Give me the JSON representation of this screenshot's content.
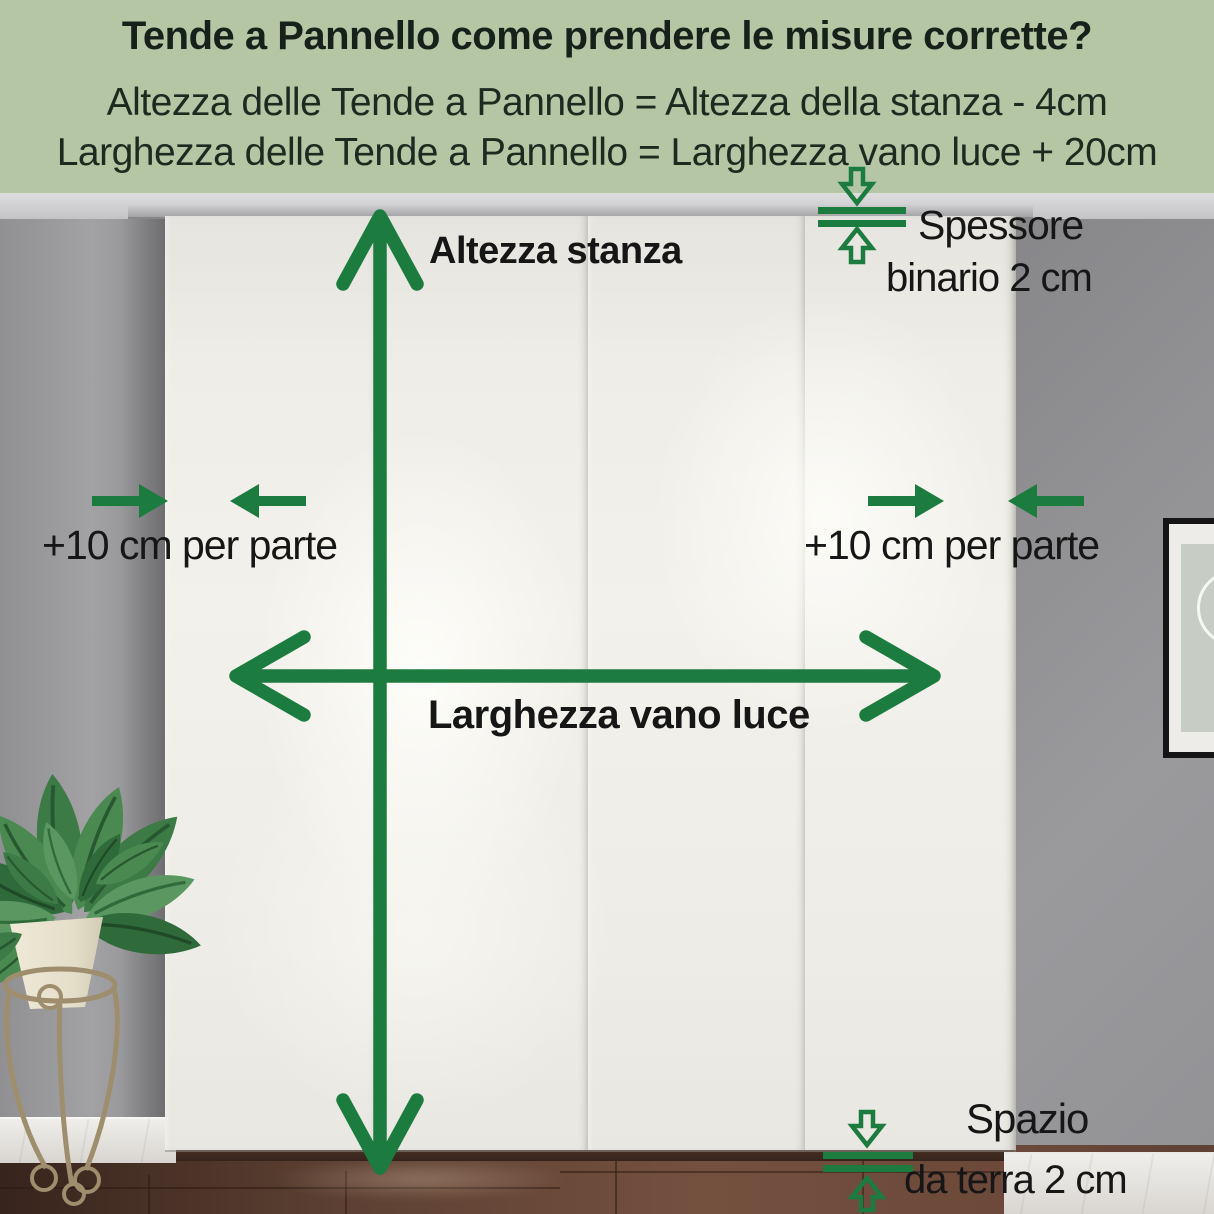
{
  "colors": {
    "header_bg": "#b5c6a5",
    "accent_green": "#1c7c3f",
    "text_dark": "#16211a",
    "curtain_white": "#f3f1eb",
    "wall_gray": "#97979a",
    "floor_brown": "#6b4839"
  },
  "header": {
    "title": "Tende a Pannello come prendere le misure corrette?",
    "formula_height": "Altezza delle Tende a Pannello = Altezza della stanza - 4cm",
    "formula_width": "Larghezza delle Tende a Pannello = Larghezza vano luce + 20cm"
  },
  "annotations": {
    "room_height_label": "Altezza stanza",
    "opening_width_label": "Larghezza vano luce",
    "left_extension_label": "+10 cm per parte",
    "right_extension_label": "+10 cm per parte",
    "track_thickness_label_line1": "Spessore",
    "track_thickness_label_line2": "binario 2 cm",
    "floor_gap_label_line1": "Spazio",
    "floor_gap_label_line2": "da terra 2 cm"
  },
  "icons": {
    "room_height": "vertical-double-headed-arrow",
    "opening_width": "horizontal-double-headed-arrow",
    "extensions": "opposing-solid-arrows",
    "track_thickness": "outline-arrows-with-double-bars",
    "floor_gap": "outline-arrows-with-double-bars"
  }
}
